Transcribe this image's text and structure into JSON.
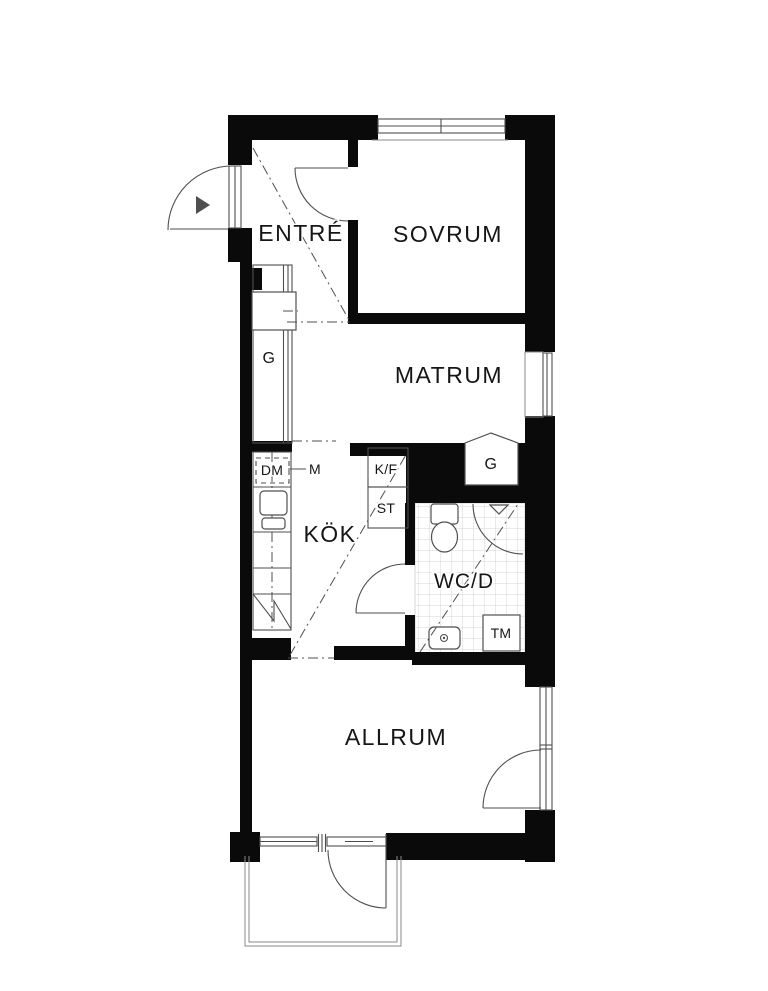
{
  "plan": {
    "type": "apartment-floor-plan",
    "rooms": [
      {
        "id": "entre",
        "label": "ENTRÉ"
      },
      {
        "id": "sovrum",
        "label": "SOVRUM"
      },
      {
        "id": "matrum",
        "label": "MATRUM"
      },
      {
        "id": "kok",
        "label": "KÖK"
      },
      {
        "id": "wcd",
        "label": "WC/D"
      },
      {
        "id": "allrum",
        "label": "ALLRUM"
      }
    ],
    "fixtures": {
      "closet_entre": "G",
      "closet_hall": "G",
      "dishwasher": "DM",
      "micro": "M",
      "fridge_freezer": "K/F",
      "pantry": "ST",
      "washing_machine": "TM"
    }
  },
  "colors": {
    "background": "#ffffff",
    "wall": "#0a0a0a",
    "line": "#4f4f4f",
    "thin_line": "#8a8a8a",
    "tile": "#d6d6d6",
    "text": "#161616"
  }
}
